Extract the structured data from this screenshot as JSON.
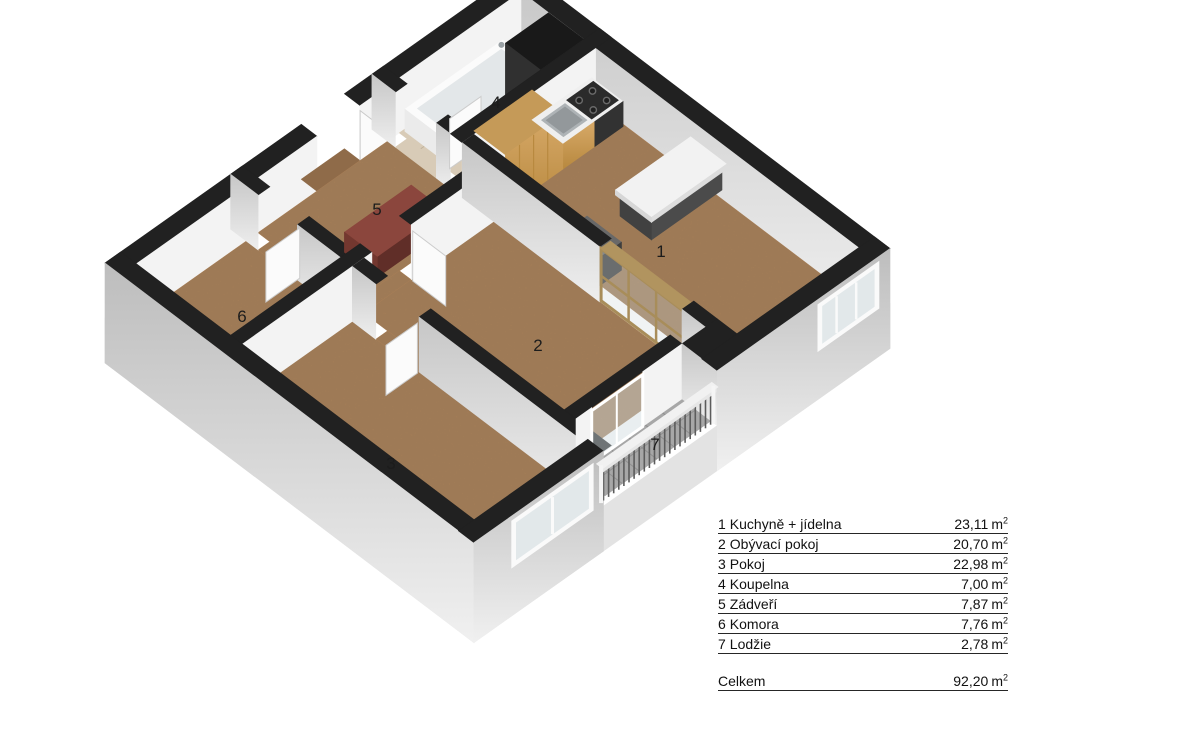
{
  "legend": {
    "rows": [
      {
        "number": "1",
        "name": "Kuchyně + jídelna",
        "area": "23,11",
        "unit": "m",
        "exponent": "2"
      },
      {
        "number": "2",
        "name": "Obývací pokoj",
        "area": "20,70",
        "unit": "m",
        "exponent": "2"
      },
      {
        "number": "3",
        "name": "Pokoj",
        "area": "22,98",
        "unit": "m",
        "exponent": "2"
      },
      {
        "number": "4",
        "name": "Koupelna",
        "area": "7,00",
        "unit": "m",
        "exponent": "2"
      },
      {
        "number": "5",
        "name": "Zádveří",
        "area": "7,87",
        "unit": "m",
        "exponent": "2"
      },
      {
        "number": "6",
        "name": "Komora",
        "area": "7,76",
        "unit": "m",
        "exponent": "2"
      },
      {
        "number": "7",
        "name": "Lodžie",
        "area": "2,78",
        "unit": "m",
        "exponent": "2"
      }
    ],
    "total": {
      "label": "Celkem",
      "area": "92,20",
      "unit": "m",
      "exponent": "2"
    }
  },
  "plan": {
    "room_numbers": [
      "1",
      "2",
      "3",
      "4",
      "5",
      "6",
      "7"
    ],
    "palette": {
      "wallTop": "#212121",
      "wallFaceWhite": "#f3f3f3",
      "wallFaceGrayTop": "#c7c7c7",
      "wallFaceGrayBottom": "#eeeeee",
      "exteriorTop": "#bdbdbd",
      "exteriorBottom": "#f0f0f0",
      "slab": "#e3e3e3",
      "floorCork": "#ad8158",
      "threshold": "#8f6b49",
      "floorTileBath": "#d8cbb7",
      "tileBathLine": "#bfb19b",
      "floorLoggia": "#a7a7a7",
      "tileLoggiaLine": "#8f8f8f",
      "wood": "#d7a968",
      "woodDark": "#b8893f",
      "woodTop": "#c59a58",
      "counter": "#efefef",
      "steel": "#aeb3b6",
      "steelDark": "#93989b",
      "appliance": "#2e2e2e",
      "applianceLight": "#686868",
      "maroonTop": "#8b463d",
      "maroonFront": "#602e28",
      "maroonSide": "#73372f",
      "glass": "#cfdade",
      "doorLeaf": "#fbfbfb",
      "frameWood": "#a88d5a",
      "railingSlat": "#5c5c5c",
      "railingLight": "#e9e9e9",
      "tubWhite": "#fbfbfb",
      "tubBasin": "#e3e7e9",
      "labelColor": "#1c1c1c"
    }
  }
}
